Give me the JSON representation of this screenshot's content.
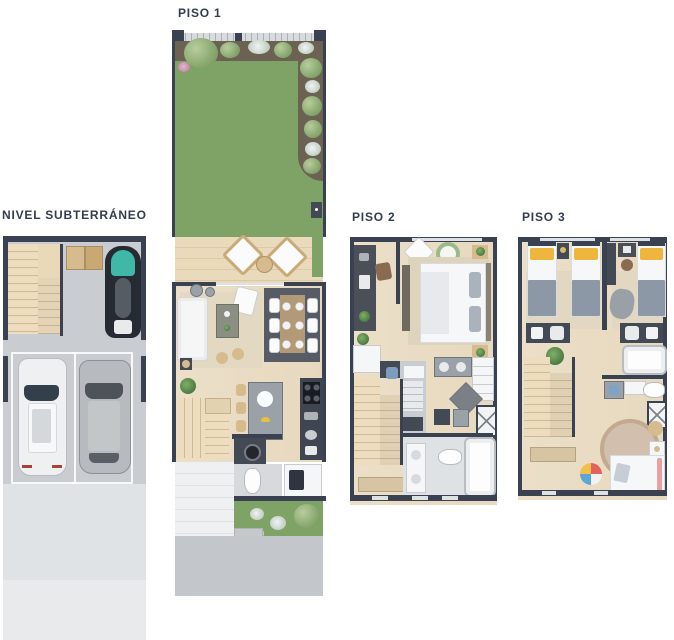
{
  "labels": {
    "piso1": "PISO 1",
    "subterraneo": "NIVEL SUBTERRÁNEO",
    "piso2": "PISO 2",
    "piso3": "PISO 3"
  },
  "palette": {
    "label_text": "#343c4e",
    "wall": "#3a4150",
    "wood_floor": "#ecdfc8",
    "deck_wood": "#e7d8b8",
    "grass": "#7fa266",
    "soil_bed": "#6b6254",
    "concrete_garage": "#c9cdd2",
    "driveway_light": "#e0e3e6",
    "dining_rug": "#565b66",
    "jetski_teal": "#3fb8a8",
    "pillow_yellow": "#efb63e",
    "blanket_gray": "#8c98a5"
  },
  "plans": [
    {
      "id": "subterraneo",
      "label": "NIVEL SUBTERRÁNEO",
      "features": [
        "staircase",
        "storage-boxes",
        "jet-ski",
        "two-parking-spaces",
        "white-car",
        "gray-car",
        "driveway"
      ]
    },
    {
      "id": "piso1",
      "label": "PISO 1",
      "features": [
        "front-garden",
        "planting-beds",
        "wood-deck-terrace",
        "two-lounge-chairs",
        "sofa",
        "armchair",
        "coffee-table",
        "dining-table-six-chairs",
        "kitchen-island-with-stools",
        "kitchen-counter",
        "staircase",
        "powder-bathroom",
        "laundry",
        "rear-garden",
        "driveway"
      ]
    },
    {
      "id": "piso2",
      "label": "PISO 2",
      "features": [
        "study-desk",
        "master-bedroom-double-bed",
        "closet",
        "walk-in-closet",
        "staircase",
        "bathroom-with-tub",
        "shower",
        "laundry-appliances"
      ]
    },
    {
      "id": "piso3",
      "label": "PISO 3",
      "features": [
        "bedroom-two-single-beds",
        "bedroom-single-bed",
        "study-desk",
        "lounge-chair",
        "bathroom-with-tub",
        "shower",
        "staircase",
        "kids-round-rug",
        "toddler-bed",
        "toy-ball"
      ]
    }
  ]
}
